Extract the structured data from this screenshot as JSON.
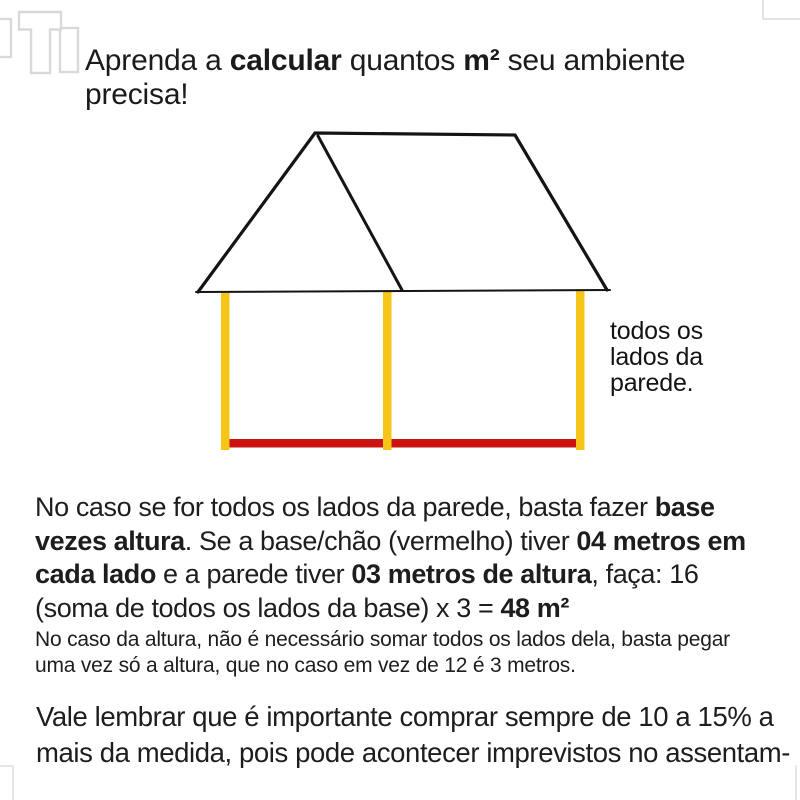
{
  "title": {
    "s1": "Aprenda a ",
    "s2": "calcular",
    "s3": " quantos ",
    "s4": "m²",
    "s5": " seu ambiente precisa!"
  },
  "logo": {
    "glyph": "T",
    "color": "#d9d9d9"
  },
  "diagram": {
    "label": {
      "line1": "todos os",
      "line2": "lados da",
      "line3": "parede."
    },
    "colors": {
      "wall_yellow": "#F5C517",
      "base_red": "#CB1311",
      "roof_black": "#141414"
    }
  },
  "paragraph1": {
    "s1": "No caso se for todos os lados da parede, basta fazer ",
    "s2": "base",
    "s3": "vezes altura",
    "s4": ". Se a base/chão (vermelho) tiver ",
    "s5": "04 metros em",
    "s6": "cada lado",
    "s7": " e a parede tiver ",
    "s8": "03 metros de altura",
    "s9": ", faça: 16",
    "s10": "(soma de todos os lados da base) x 3 = ",
    "s11": "48 m²"
  },
  "paragraph2": {
    "line1": "No caso da altura, não é necessário somar todos os lados dela, basta pegar",
    "line2": "uma vez só a altura, que no caso em vez de 12 é 3 metros."
  },
  "paragraph3": {
    "line1": "Vale lembrar que é importante comprar sempre de 10 a 15% a",
    "line2": "mais da medida, pois pode acontecer imprevistos no assentam-"
  }
}
